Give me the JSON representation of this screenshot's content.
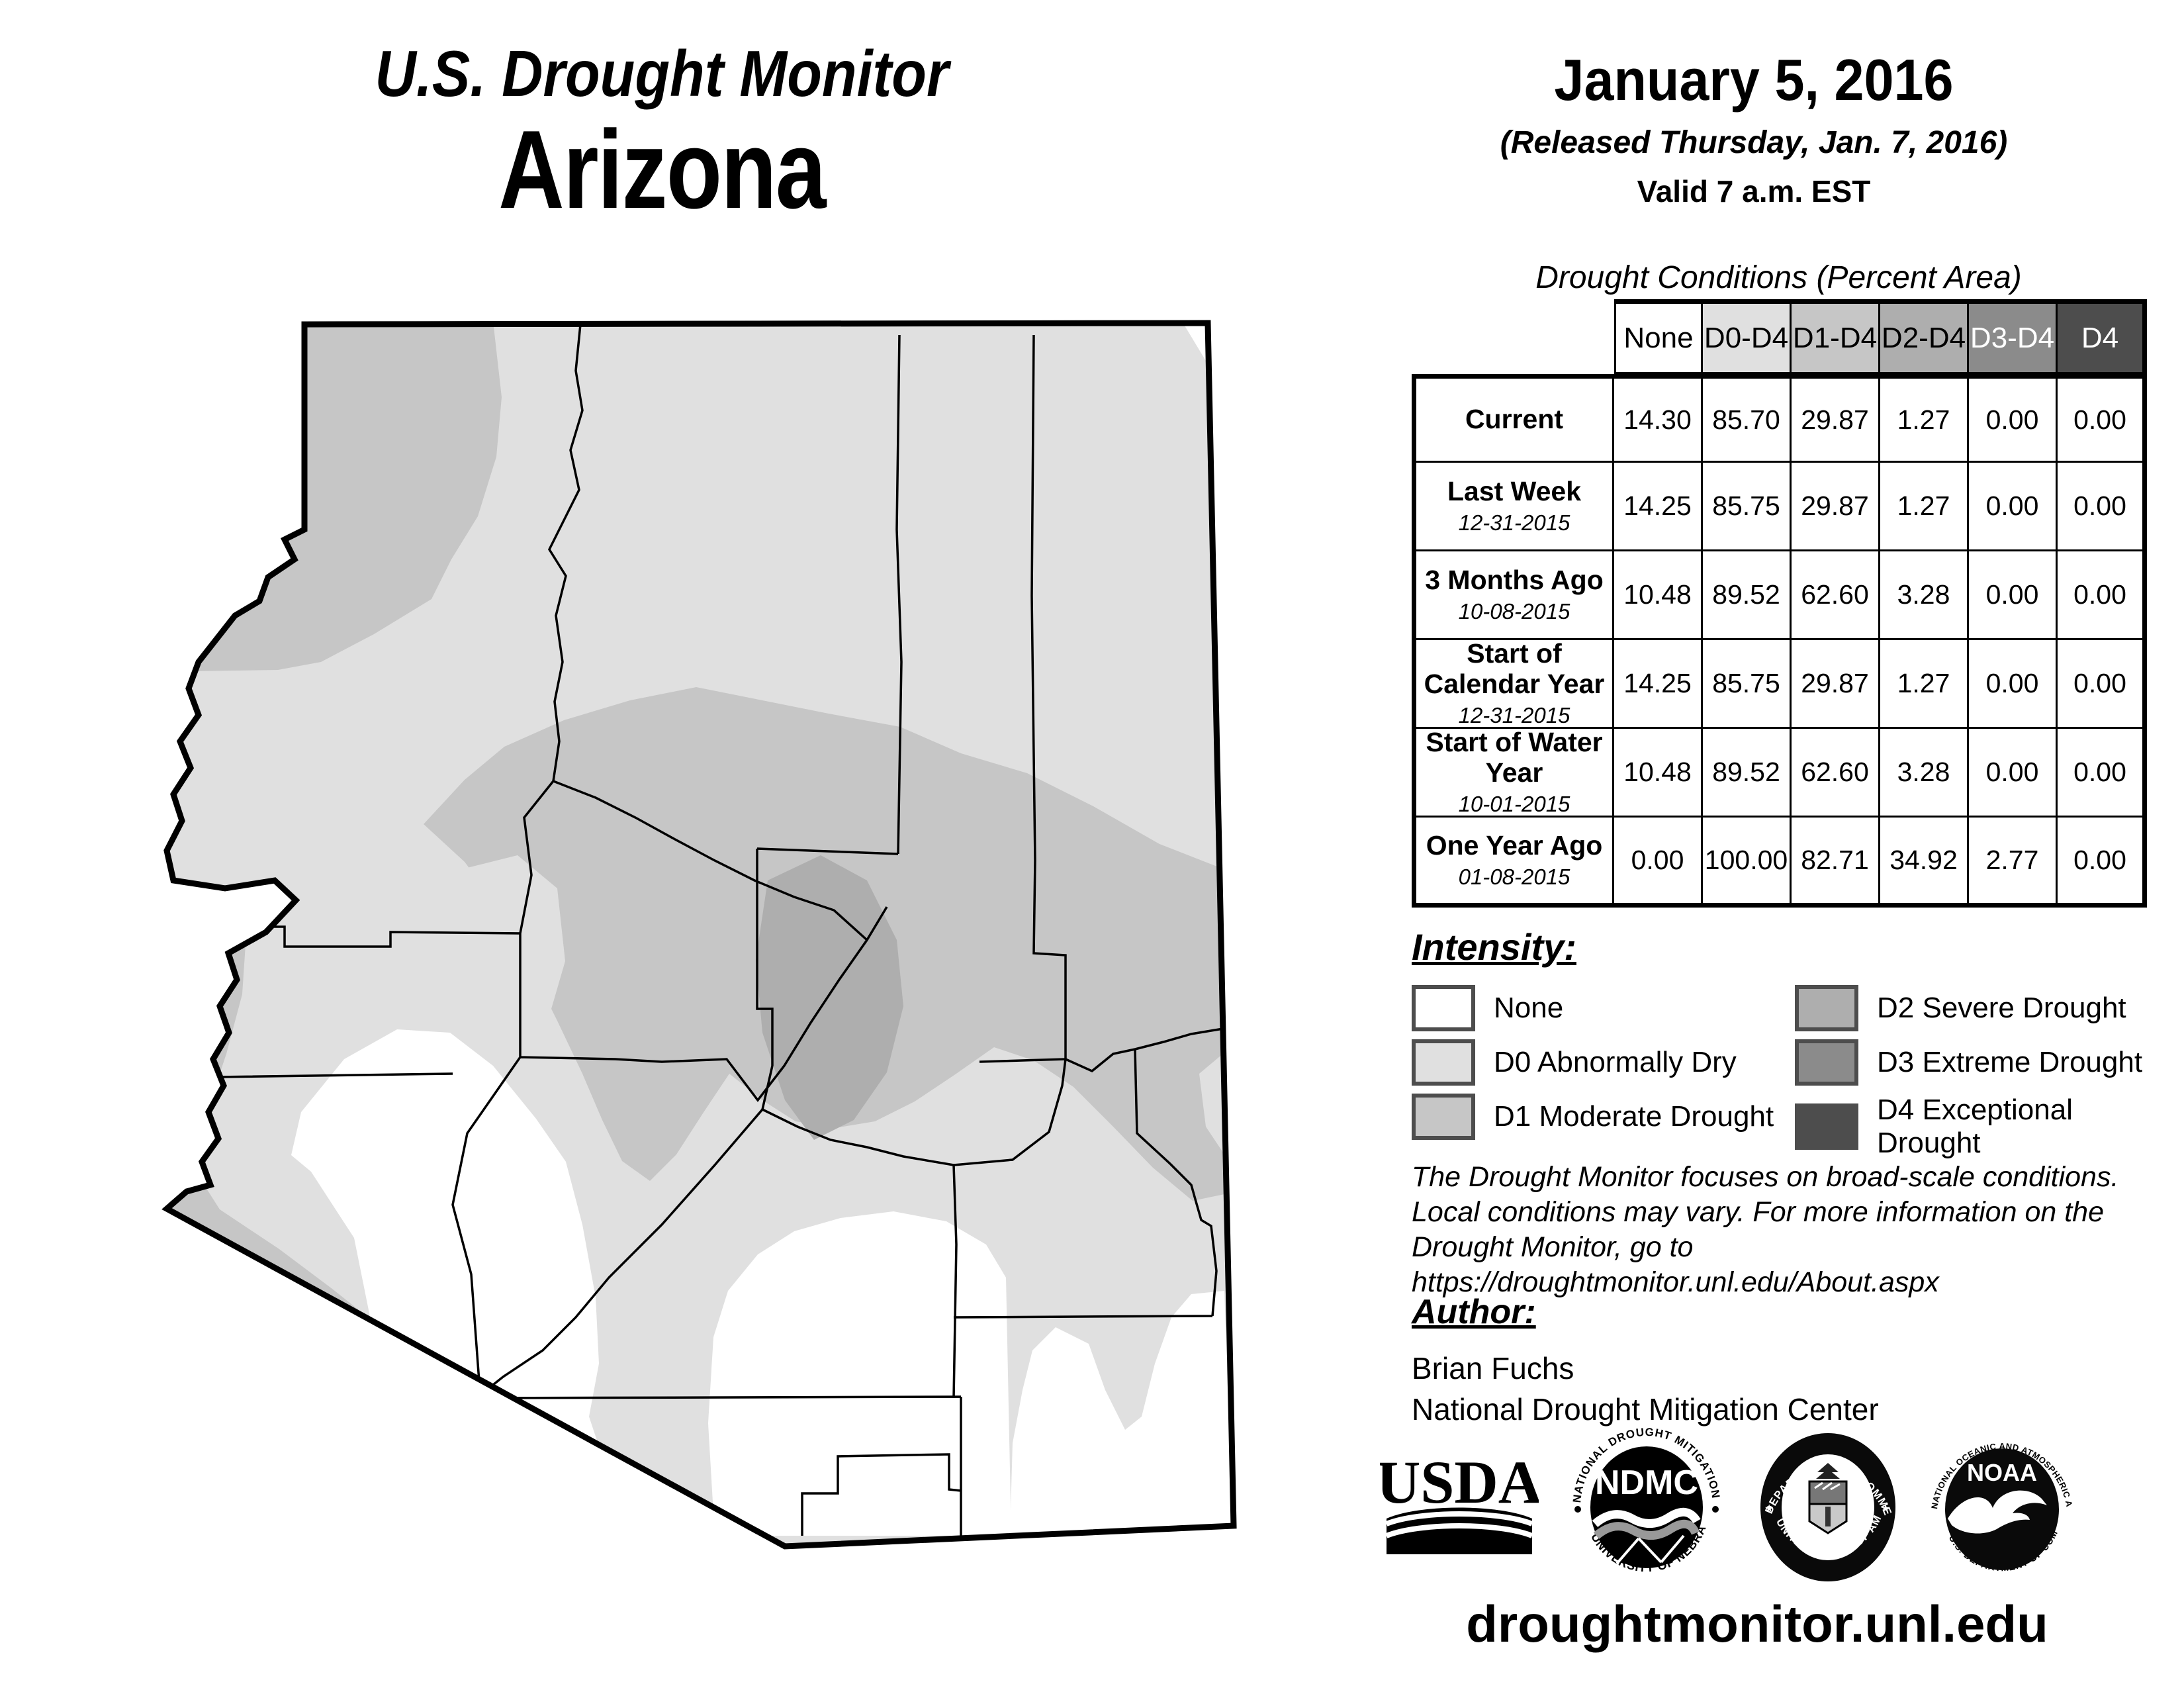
{
  "header": {
    "title": "U.S. Drought Monitor",
    "region": "Arizona",
    "date": "January 5, 2016",
    "released": "(Released Thursday, Jan. 7, 2016)",
    "valid": "Valid 7 a.m. EST"
  },
  "table": {
    "title": "Drought Conditions (Percent Area)",
    "columns": [
      "None",
      "D0-D4",
      "D1-D4",
      "D2-D4",
      "D3-D4",
      "D4"
    ],
    "rows": [
      {
        "label": "Current",
        "date": "",
        "values": [
          "14.30",
          "85.70",
          "29.87",
          "1.27",
          "0.00",
          "0.00"
        ]
      },
      {
        "label": "Last Week",
        "date": "12-31-2015",
        "values": [
          "14.25",
          "85.75",
          "29.87",
          "1.27",
          "0.00",
          "0.00"
        ]
      },
      {
        "label": "3 Months Ago",
        "date": "10-08-2015",
        "values": [
          "10.48",
          "89.52",
          "62.60",
          "3.28",
          "0.00",
          "0.00"
        ]
      },
      {
        "label": "Start of Calendar Year",
        "date": "12-31-2015",
        "values": [
          "14.25",
          "85.75",
          "29.87",
          "1.27",
          "0.00",
          "0.00"
        ]
      },
      {
        "label": "Start of Water Year",
        "date": "10-01-2015",
        "values": [
          "10.48",
          "89.52",
          "62.60",
          "3.28",
          "0.00",
          "0.00"
        ]
      },
      {
        "label": "One Year Ago",
        "date": "01-08-2015",
        "values": [
          "0.00",
          "100.00",
          "82.71",
          "34.92",
          "2.77",
          "0.00"
        ]
      }
    ]
  },
  "legend": {
    "title": "Intensity:",
    "items": [
      {
        "label": "None",
        "color": "#ffffff"
      },
      {
        "label": "D0 Abnormally Dry",
        "color": "#e0e0e0"
      },
      {
        "label": "D1 Moderate Drought",
        "color": "#c6c6c6"
      },
      {
        "label": "D2 Severe Drought",
        "color": "#aeaeae"
      },
      {
        "label": "D3 Extreme Drought",
        "color": "#8b8b8b"
      },
      {
        "label": "D4 Exceptional Drought",
        "color": "#4d4d4d"
      }
    ]
  },
  "disclaimer": {
    "line1": "The Drought Monitor focuses on broad-scale conditions.",
    "line2": "Local conditions may vary. For more information on the",
    "line3": "Drought Monitor, go to https://droughtmonitor.unl.edu/About.aspx"
  },
  "author": {
    "title": "Author:",
    "name": "Brian Fuchs",
    "org": "National Drought Mitigation Center"
  },
  "footer": {
    "url": "droughtmonitor.unl.edu"
  },
  "logos": {
    "usda": {
      "text": "USDA"
    },
    "ndmc": {
      "center": "NDMC",
      "top": "NATIONAL DROUGHT MITIGATION CENTER",
      "bottom": "UNIVERSITY OF NEBRASKA"
    },
    "doc": {
      "top": "DEPARTMENT OF COMMERCE",
      "bottom": "UNITED STATES OF AMERICA"
    },
    "noaa": {
      "center": "NOAA",
      "top": "NATIONAL OCEANIC AND ATMOSPHERIC ADMINISTRATION",
      "bottom": "U.S. DEPARTMENT OF COMMERCE"
    }
  },
  "map": {
    "region": "Arizona state drought map",
    "colors": {
      "none": "#ffffff",
      "d0": "#e0e0e0",
      "d1": "#c6c6c6",
      "d2": "#aeaeae",
      "d3": "#8b8b8b",
      "d4": "#4d4d4d",
      "border": "#000000"
    }
  }
}
